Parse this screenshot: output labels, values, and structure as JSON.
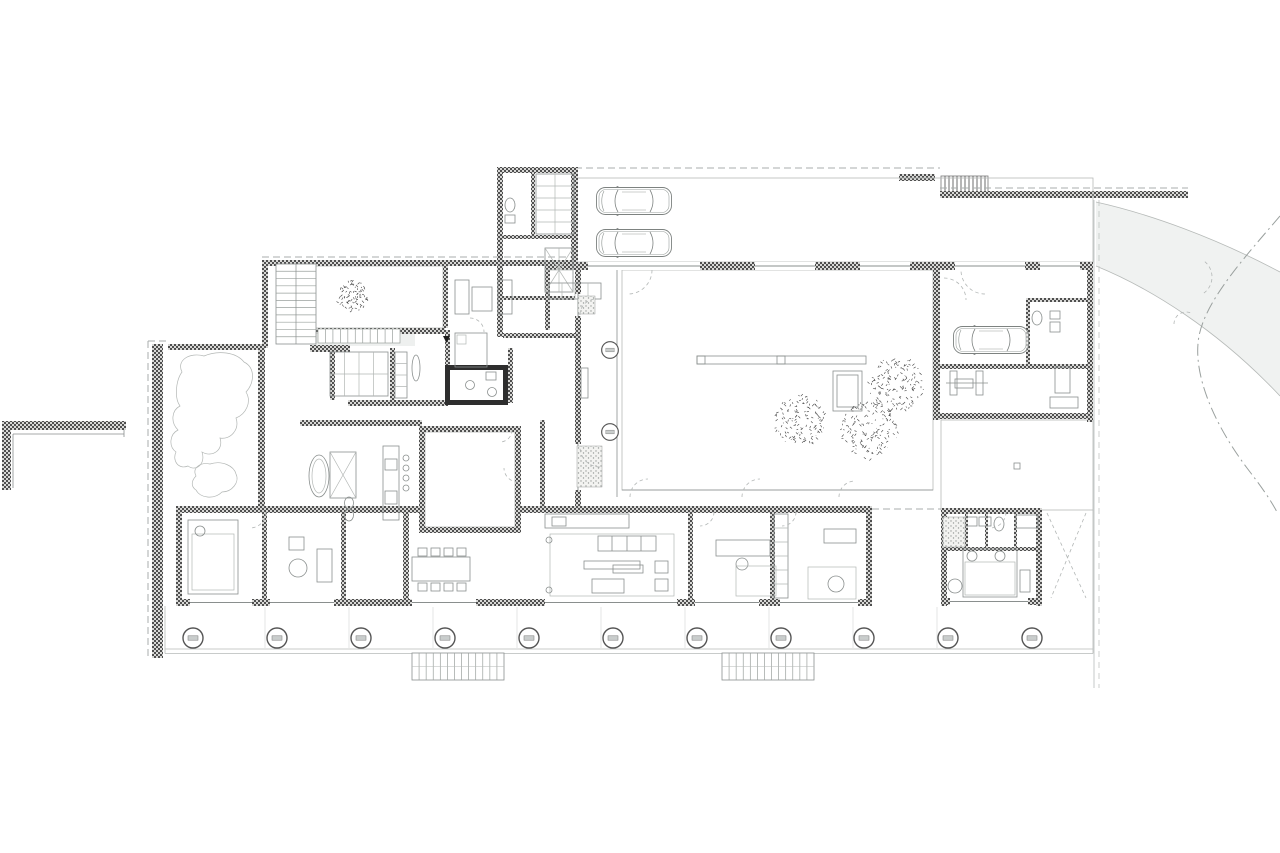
{
  "scene": {
    "type": "architectural-floor-plan",
    "view": "ground-floor-courtyard-house",
    "canvas_w": 1280,
    "canvas_h": 853
  },
  "colors": {
    "background": "#ffffff",
    "paving": "#e9eceb",
    "paving_grid": "#dbdfde",
    "driveway": "#f0f2f1",
    "wall_dark": "#4f4f4f",
    "wall_light": "#d8d8d6",
    "wall_solid_dark": "#2e2e2e",
    "speck_bg": "#f3f3f1",
    "speck_dot": "#9a9e9c",
    "line_thin": "#8a8f8e",
    "tree_stroke": "#3c3c3c",
    "column_stroke": "#555555",
    "column_bar": "#c9cdcc"
  },
  "veranda_columns": {
    "cy": 638,
    "r": 10,
    "xs": [
      193,
      277,
      361,
      445,
      529,
      613,
      697,
      781,
      864,
      948,
      1032
    ]
  },
  "courtyard_columns": {
    "r": 8,
    "pts": [
      [
        610,
        350
      ],
      [
        610,
        432
      ]
    ]
  },
  "trees": [
    [
      353,
      296,
      16
    ],
    [
      801,
      421,
      26
    ],
    [
      869,
      430,
      29
    ],
    [
      896,
      384,
      28
    ]
  ],
  "cars": [
    [
      596,
      186
    ],
    [
      596,
      228
    ],
    [
      953,
      325
    ]
  ],
  "exterior_stairs": [
    [
      412,
      653,
      92,
      27,
      13
    ],
    [
      722,
      653,
      92,
      27,
      13
    ]
  ],
  "interior_stair": {
    "x": 276,
    "y": 264,
    "w": 40,
    "h": 80,
    "treads": 11
  },
  "terrace_steps": {
    "x": 318,
    "y": 329,
    "w": 82,
    "h": 14,
    "treads": 11
  },
  "entry_mats": [
    [
      578,
      296,
      17,
      18
    ],
    [
      577,
      446,
      25,
      41
    ],
    [
      943,
      517,
      22,
      30
    ]
  ],
  "door_arcs": [
    [
      596,
      315,
      16,
      180,
      270
    ],
    [
      600,
      447,
      20,
      90,
      180
    ],
    [
      648,
      497,
      18,
      180,
      270
    ],
    [
      760,
      497,
      18,
      180,
      270
    ],
    [
      855,
      497,
      16,
      180,
      270
    ],
    [
      628,
      270,
      24,
      0,
      90
    ],
    [
      985,
      270,
      24,
      90,
      180
    ],
    [
      990,
      512,
      16,
      0,
      90
    ],
    [
      250,
      512,
      16,
      0,
      90
    ],
    [
      470,
      332,
      14,
      270,
      360
    ],
    [
      518,
      468,
      14,
      90,
      180
    ],
    [
      700,
      512,
      14,
      0,
      90
    ],
    [
      782,
      512,
      14,
      0,
      90
    ],
    [
      944,
      300,
      22,
      270,
      360
    ],
    [
      500,
      430,
      12,
      0,
      90
    ],
    [
      1192,
      277,
      20,
      310,
      60
    ],
    [
      1186,
      324,
      12,
      180,
      300
    ]
  ],
  "windows_horizontal": [
    [
      190,
      599,
      62,
      7
    ],
    [
      270,
      599,
      64,
      7
    ],
    [
      412,
      599,
      64,
      7
    ],
    [
      545,
      599,
      132,
      7
    ],
    [
      695,
      599,
      64,
      7
    ],
    [
      780,
      599,
      78,
      7
    ],
    [
      950,
      598,
      78,
      7
    ],
    [
      588,
      262,
      86,
      8
    ],
    [
      640,
      262,
      60,
      8
    ],
    [
      755,
      262,
      60,
      8
    ],
    [
      860,
      262,
      50,
      8
    ],
    [
      955,
      262,
      70,
      8
    ],
    [
      1040,
      262,
      40,
      8
    ]
  ],
  "windows_vertical": [
    [
      575,
      294,
      6,
      22
    ],
    [
      575,
      444,
      6,
      46
    ]
  ],
  "dining_chairs": {
    "xs": [
      418,
      431,
      444,
      457
    ],
    "rows": [
      548,
      583
    ],
    "size": 9
  }
}
